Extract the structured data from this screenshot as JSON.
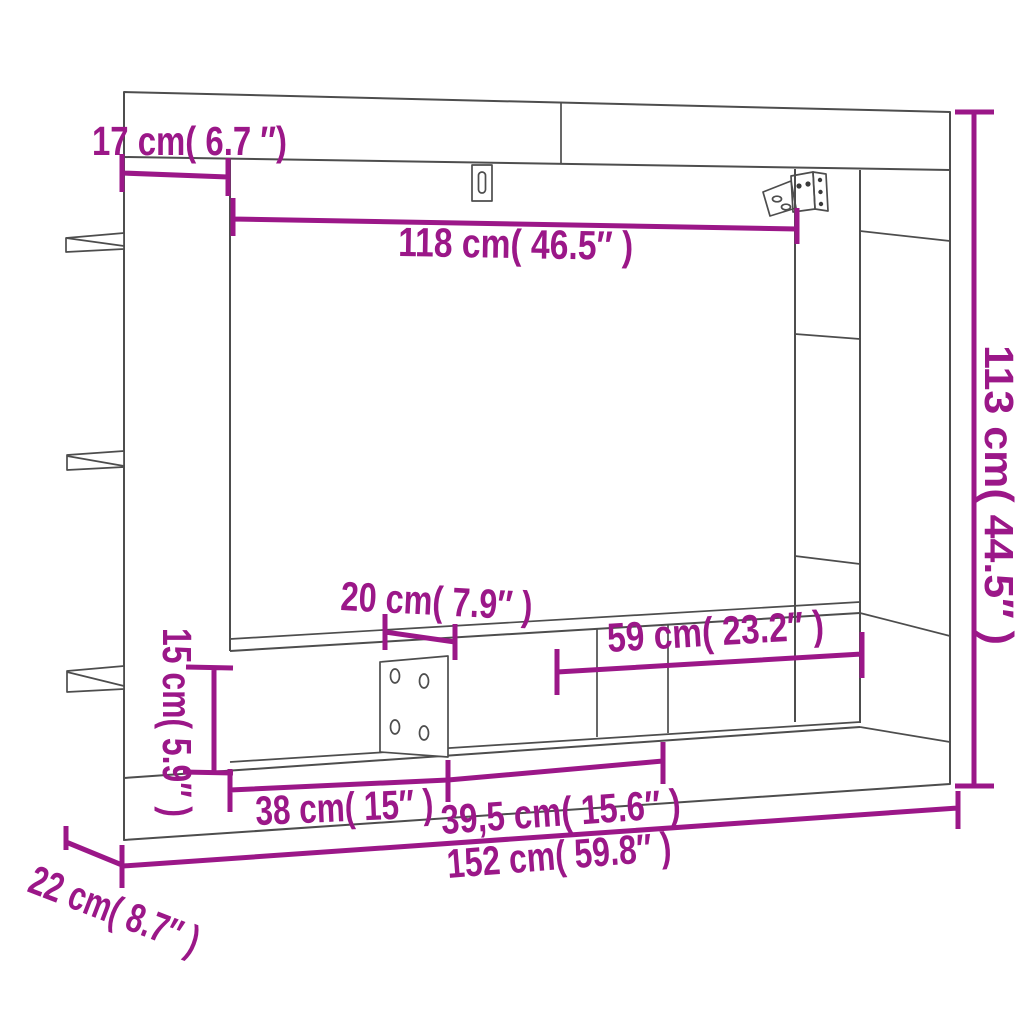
{
  "figure": {
    "kind": "furniture dimension diagram",
    "accent_color": "#9B1788",
    "outline_color": "#4D4D4D",
    "background": "#FFFFFF"
  },
  "dimensions": {
    "top_depth": {
      "label": "17 cm( 6.7 ″)",
      "cm": "17",
      "inches": "6.7"
    },
    "opening_width": {
      "label": "118 cm( 46.5″ )",
      "cm": "118",
      "inches": "46.5"
    },
    "total_height": {
      "label": "113 cm( 44.5″ )",
      "cm": "113",
      "inches": "44.5"
    },
    "cable_panel_width": {
      "label": "20 cm( 7.9″ )",
      "cm": "20",
      "inches": "7.9"
    },
    "right_shelf_width": {
      "label": "59 cm( 23.2″ )",
      "cm": "59",
      "inches": "23.2"
    },
    "stand_height": {
      "label": "15 cm( 5.9″ )",
      "cm": "15",
      "inches": "5.9"
    },
    "left_compartment_width": {
      "label": "38 cm( 15″ )",
      "cm": "38",
      "inches": "15"
    },
    "middle_compartment_width": {
      "label": "39,5 cm( 15.6″ )",
      "cm": "39,5",
      "inches": "15.6"
    },
    "total_width": {
      "label": "152 cm( 59.8″ )",
      "cm": "152",
      "inches": "59.8"
    },
    "side_depth": {
      "label": "22 cm( 8.7″ )",
      "cm": "22",
      "inches": "8.7"
    }
  },
  "icons": {
    "keyhole_mount": "keyhole-mount-icon",
    "wall_bracket": "wall-bracket-icon"
  }
}
